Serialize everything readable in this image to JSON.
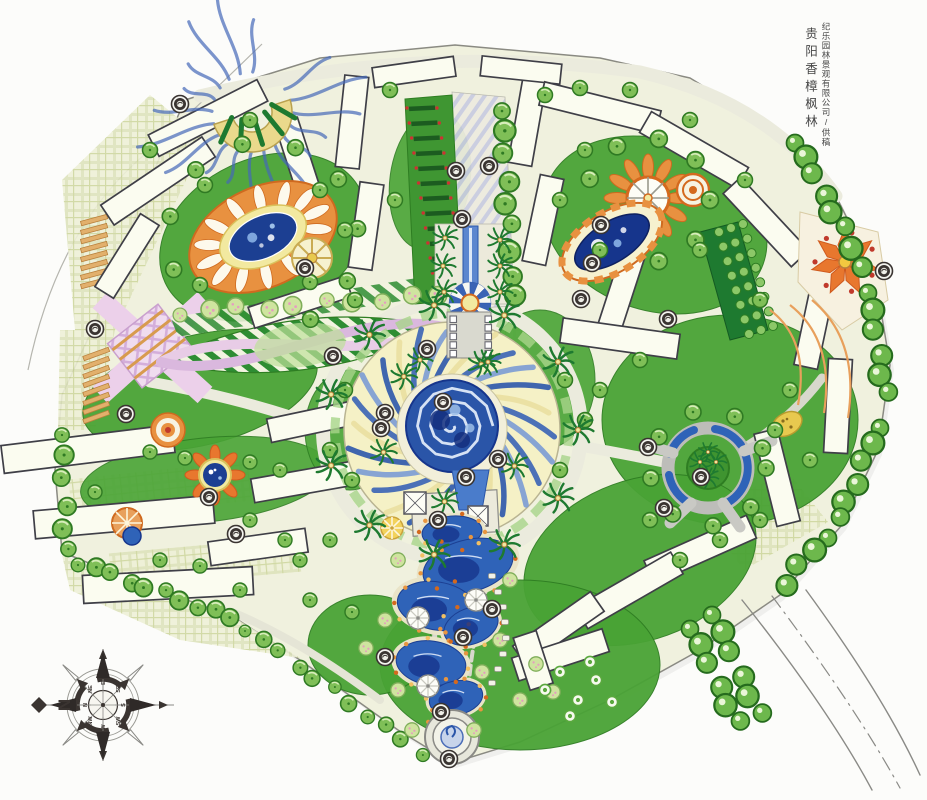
{
  "credits": {
    "project_title": "贵阳香樟枫林",
    "credit_line": "纪乐园林景观有限公司/供稿"
  },
  "compass": {
    "north_label": "N",
    "inner_labels": [
      "N",
      "NE",
      "E",
      "SE",
      "S",
      "SW",
      "W",
      "NW"
    ]
  },
  "palette": {
    "paper": "#fafaf6",
    "site_ground": "#f0f1de",
    "lawn_green": "#49a335",
    "tree_green": "#7fbf57",
    "hedge_green": "#1e7a30",
    "water_blue": "#2f63b8",
    "deep_water_blue": "#16358c",
    "accent_orange": "#e89140",
    "paving_yellow": "#f2e9a0",
    "paving_pink": "#ecd0ea",
    "road_gray": "#b5b5b7",
    "ink_marker": "#3a3431"
  }
}
